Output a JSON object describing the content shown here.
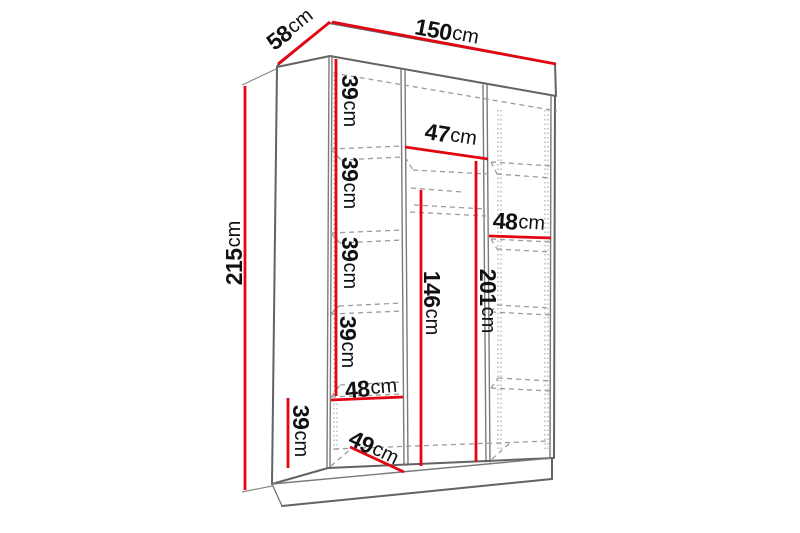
{
  "diagram": {
    "title": "Wardrobe interior dimension diagram",
    "unit": "cm",
    "colors": {
      "dimension": "#e20613",
      "structure": "#636363",
      "hidden_lines": "#9b9b9b",
      "text": "#111111",
      "background": "#ffffff"
    },
    "overall": {
      "width": "150cm",
      "depth": "58cm",
      "height": "215cm"
    },
    "dimensions": [
      {
        "id": "depth-58",
        "value": "58",
        "unit": "cm",
        "line": [
          278,
          64,
          330,
          22
        ],
        "label": [
          290,
          29
        ],
        "rotate": -38
      },
      {
        "id": "width-150",
        "value": "150",
        "unit": "cm",
        "line": [
          332,
          22,
          556,
          64
        ],
        "label": [
          447,
          32
        ],
        "rotate": 10.5
      },
      {
        "id": "height-215",
        "value": "215",
        "unit": "cm",
        "line": [
          245,
          86,
          245,
          490
        ],
        "label": [
          234,
          253
        ],
        "rotate": -90
      },
      {
        "id": "left-shelf-39-1",
        "value": "39",
        "unit": "cm",
        "line": [
          336,
          59,
          336,
          148
        ],
        "label": [
          350,
          101
        ],
        "rotate": 90
      },
      {
        "id": "left-shelf-39-2",
        "value": "39",
        "unit": "cm",
        "line": [
          336,
          148,
          336,
          232
        ],
        "label": [
          350,
          183
        ],
        "rotate": 90
      },
      {
        "id": "left-shelf-39-3",
        "value": "39",
        "unit": "cm",
        "line": [
          336,
          232,
          336,
          313
        ],
        "label": [
          350,
          263
        ],
        "rotate": 90
      },
      {
        "id": "left-shelf-39-4",
        "value": "39",
        "unit": "cm",
        "line": [
          336,
          313,
          336,
          396
        ],
        "label": [
          348,
          342
        ],
        "rotate": 90
      },
      {
        "id": "left-shelf-width-48",
        "value": "48",
        "unit": "cm",
        "line": [
          331,
          400,
          403,
          397
        ],
        "label": [
          371,
          388
        ],
        "rotate": -5
      },
      {
        "id": "left-bottom-39",
        "value": "39",
        "unit": "cm",
        "line": [
          288,
          398,
          288,
          468
        ],
        "label": [
          301,
          431
        ],
        "rotate": 90
      },
      {
        "id": "floor-depth-49",
        "value": "49",
        "unit": "cm",
        "line": [
          350,
          447,
          404,
          472
        ],
        "label": [
          374,
          448
        ],
        "rotate": 26
      },
      {
        "id": "middle-shelf-width-47",
        "value": "47",
        "unit": "cm",
        "line": [
          405,
          147,
          488,
          159
        ],
        "label": [
          451,
          135
        ],
        "rotate": 9
      },
      {
        "id": "hanging-height-146",
        "value": "146",
        "unit": "cm",
        "line": [
          421,
          190,
          421,
          466
        ],
        "label": [
          432,
          303
        ],
        "rotate": 90
      },
      {
        "id": "right-height-201",
        "value": "201",
        "unit": "cm",
        "line": [
          476,
          161,
          476,
          462
        ],
        "label": [
          488,
          301
        ],
        "rotate": 90
      },
      {
        "id": "right-shelf-width-48",
        "value": "48",
        "unit": "cm",
        "line": [
          489,
          236,
          551,
          238
        ],
        "label": [
          519,
          222
        ],
        "rotate": 4
      }
    ]
  }
}
